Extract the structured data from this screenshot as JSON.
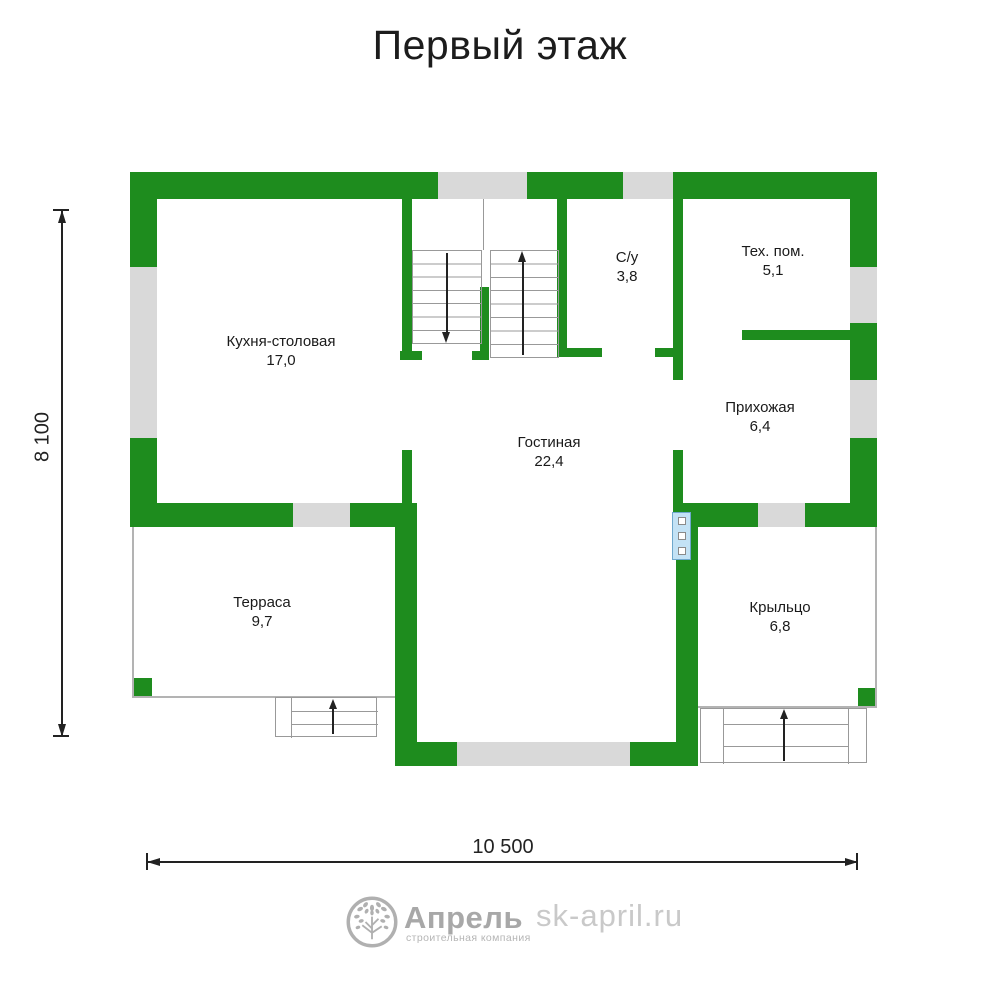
{
  "title": "Первый этаж",
  "plan": {
    "rooms": [
      {
        "name": "Кухня-столовая",
        "area": "17,0"
      },
      {
        "name": "С/у",
        "area": "3,8"
      },
      {
        "name": "Тех. пом.",
        "area": "5,1"
      },
      {
        "name": "Прихожая",
        "area": "6,4"
      },
      {
        "name": "Гостиная",
        "area": "22,4"
      },
      {
        "name": "Терраса",
        "area": "9,7"
      },
      {
        "name": "Крыльцо",
        "area": "6,8"
      }
    ],
    "dimensions": {
      "height": "8 100",
      "width": "10 500"
    }
  },
  "footer": {
    "brand": "Апрель",
    "brand_subtitle": "строительная компания",
    "website": "sk-april.ru"
  },
  "colors": {
    "wall": "#1e8c1e",
    "window": "#d9d9d9",
    "door": "#c3e2f5",
    "door_border": "#6fa8cc",
    "line": "#999999",
    "outline": "#b3b3b3",
    "text": "#1a1a1a",
    "dim": "#222222",
    "logo": "#b0b0b0",
    "website_text": "#c9c9c9"
  }
}
